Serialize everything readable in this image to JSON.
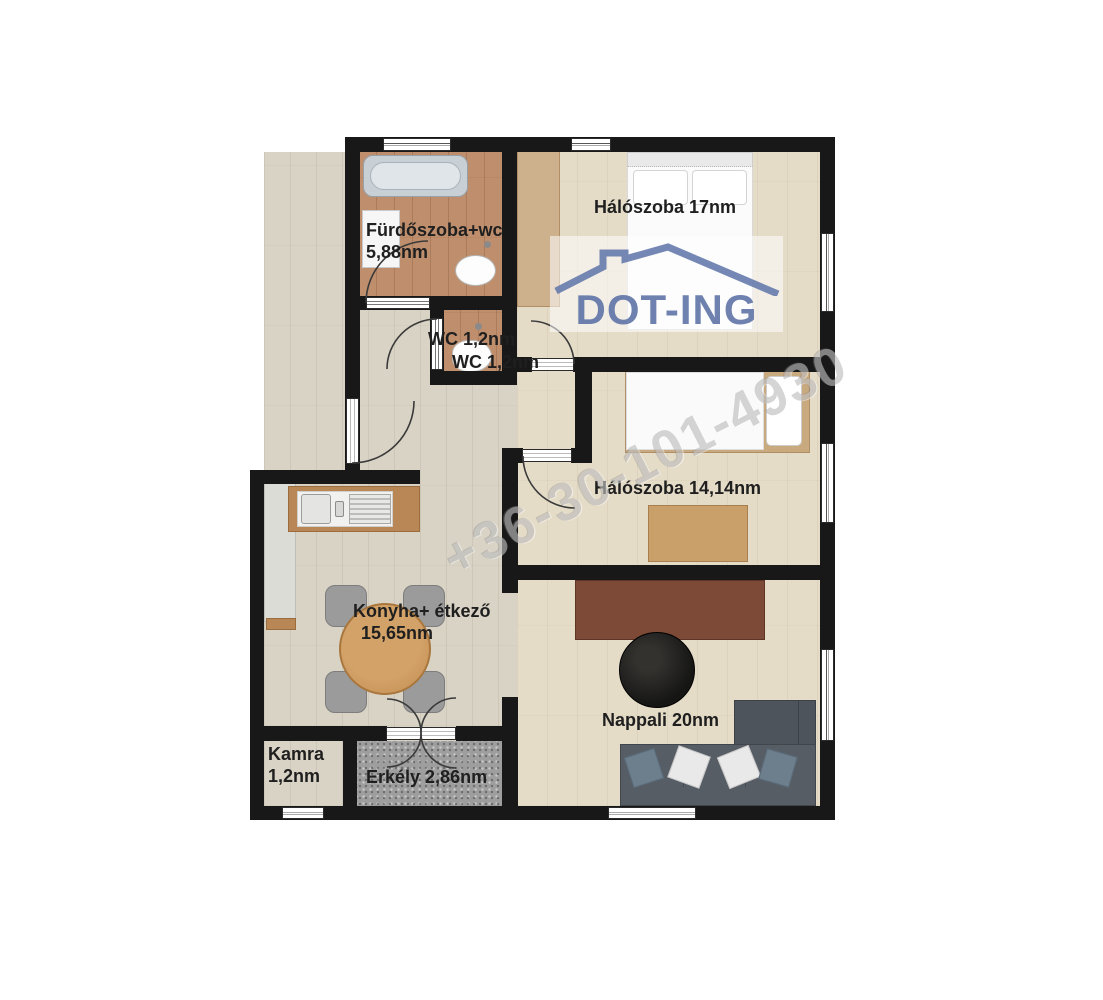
{
  "plan": {
    "labels": {
      "bathroom_name": "Fürdőszoba+wc",
      "bathroom_area": "5,88nm",
      "wc1": "WC 1,2nm",
      "wc2": "WC 1,2nm",
      "bedroom1": "Hálószoba 17nm",
      "bedroom2": "Hálószoba 14,14nm",
      "kitchen_name": "Konyha+ étkező",
      "kitchen_area": "15,65nm",
      "living": "Nappali 20nm",
      "pantry_name": "Kamra",
      "pantry_area": "1,2nm",
      "balcony": "Erkély 2,86nm"
    },
    "colors": {
      "wall": "#181818",
      "floor_light_wood": "#d9d3c5",
      "floor_warm_wood": "#e5dcc8",
      "floor_bathroom_wood": "#bf8f6d",
      "floor_balcony": "#9e9e9e"
    }
  },
  "logo": {
    "text": "DOT-ING",
    "color": "#6276a8"
  },
  "watermark": {
    "text": "+36-30-101-4930"
  }
}
